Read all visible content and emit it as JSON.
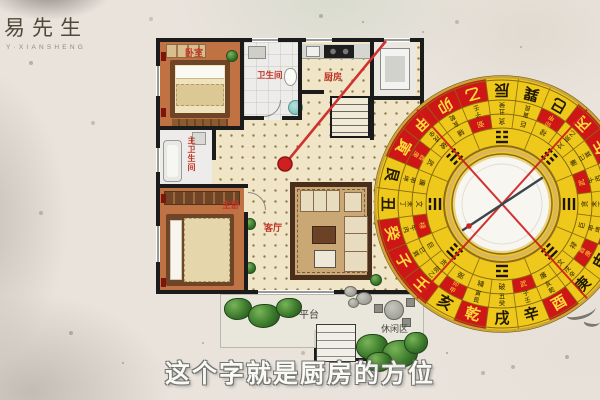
{
  "logo": {
    "title": "易先生",
    "subtitle": "Y·XIANSHENG"
  },
  "caption": "这个字就是厨房的方位",
  "floorplan": {
    "labels": {
      "bedroom": "卧室",
      "bathroom": "卫生间",
      "kitchen": "厨房",
      "master_bathroom": "主卫生间",
      "master_bedroom": "主卧",
      "living_room": "客厅",
      "terrace": "平台",
      "leisure_area": "休闲区"
    },
    "marker_color": "#cf2020"
  },
  "compass": {
    "mountains": [
      "未",
      "坤",
      "申",
      "庚",
      "酉",
      "辛",
      "戌",
      "乾",
      "亥",
      "壬",
      "子",
      "癸",
      "丑",
      "艮",
      "寅",
      "甲",
      "卯",
      "乙",
      "辰",
      "巽",
      "巳",
      "丙",
      "午",
      "丁"
    ],
    "red_mountains": [
      "子",
      "癸",
      "壬",
      "乾",
      "酉",
      "卯",
      "甲",
      "寅",
      "乙",
      "丙",
      "午",
      "坤"
    ],
    "ring2": [
      "丁未",
      "坤申",
      "庚酉",
      "辛戌",
      "乾亥",
      "壬子",
      "癸丑",
      "艮寅",
      "甲卯",
      "乙辰",
      "巽巳",
      "丙午",
      "丁未",
      "坤申",
      "庚酉",
      "辛戌",
      "乾亥",
      "壬子",
      "癸丑",
      "艮寅",
      "甲卯",
      "乙辰",
      "巽巳",
      "丙午"
    ],
    "ring2_red": [
      2,
      8,
      14,
      20
    ],
    "ring3": [
      "贪",
      "巨",
      "禄",
      "文",
      "廉",
      "武",
      "破",
      "辅",
      "弼",
      "贪",
      "巨",
      "禄",
      "文",
      "廉",
      "武",
      "破",
      "辅",
      "弼",
      "贪",
      "巨",
      "禄",
      "文",
      "廉",
      "武"
    ],
    "ring3_red": [
      5,
      11,
      17,
      23
    ],
    "trigrams": [
      [
        1,
        1,
        1
      ],
      [
        0,
        1,
        1
      ],
      [
        1,
        0,
        1
      ],
      [
        0,
        0,
        1
      ],
      [
        1,
        1,
        0
      ],
      [
        0,
        1,
        0
      ],
      [
        1,
        0,
        0
      ],
      [
        0,
        0,
        0
      ]
    ],
    "colors": {
      "face": "#eec81a",
      "red_cell": "#cf1616",
      "line": "#8a6a10",
      "center": "#f7f6f1",
      "cross": "#cf1d1d",
      "needle": "#39464c",
      "rim": "#c9a53a",
      "char_dark": "#241b00",
      "char_on_red": "#ffd83a"
    }
  }
}
